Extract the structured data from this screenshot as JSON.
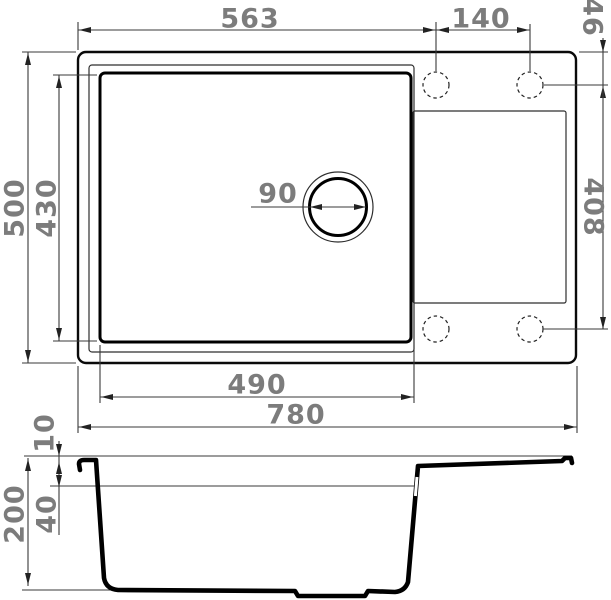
{
  "drawing": {
    "subject": "Kitchen sink with drainboard - dimensioned technical drawing",
    "views": [
      "top view",
      "side section view"
    ],
    "units_implied": "mm"
  },
  "colors": {
    "background": "#ffffff",
    "outline": "#000000",
    "dimension_line": "#3a3a3a",
    "dimension_text": "#7c7c7c"
  },
  "top_view": {
    "tap_hole_count": 4,
    "dims": {
      "overall_width": "780",
      "overall_depth": "500",
      "bowl_width": "490",
      "bowl_depth": "430",
      "drain_diameter": "90",
      "left_edge_to_tap_hole": "563",
      "tap_hole_spacing": "140",
      "edge_to_tap_row": "46",
      "tap_row_span": "408"
    }
  },
  "side_view": {
    "dims": {
      "overall_depth": "200",
      "rim_step": "10",
      "ledge_depth": "40"
    }
  }
}
